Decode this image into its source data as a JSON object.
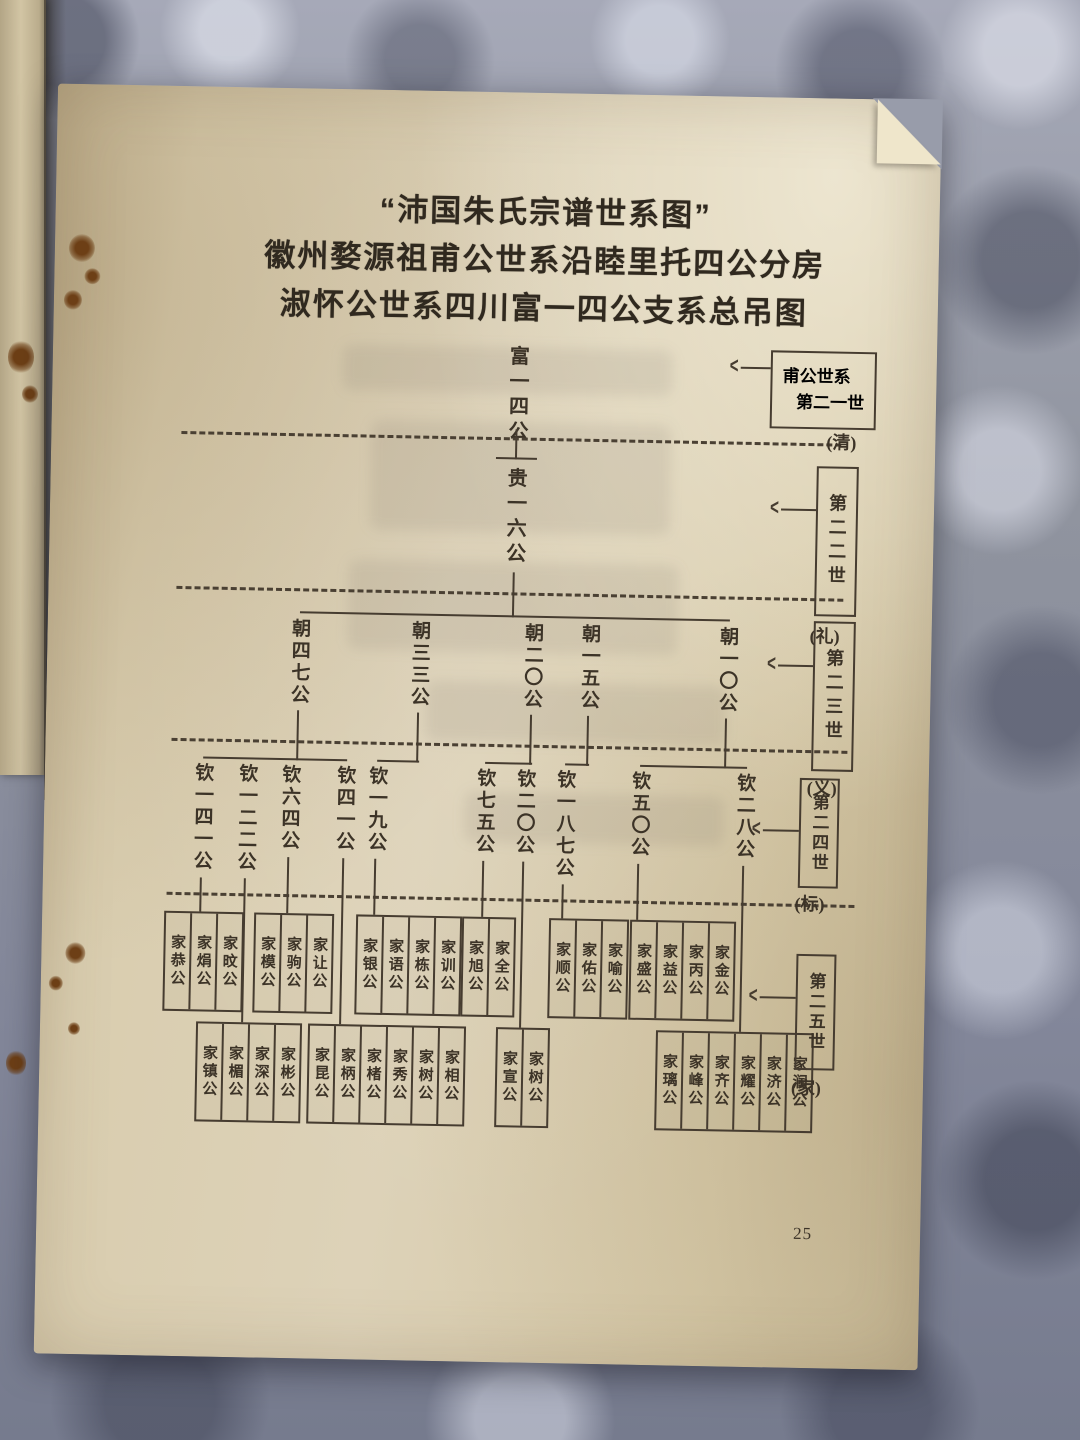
{
  "colors": {
    "ink": "#463c30",
    "paper": "#d9cdaf",
    "fabric": "#8f93a2"
  },
  "icons": {
    "generation_pointer": "<"
  },
  "page": {
    "page_number": "25"
  },
  "title": {
    "line1": "“沛国朱氏宗谱世系图”",
    "line2": "徽州婺源祖甫公世系沿睦里托四公分房",
    "line3": "淑怀公世系四川富一四公支系总吊图"
  },
  "generation_labels": [
    {
      "line1": "甫公世系",
      "line2": "第二一世",
      "note": "(清)"
    },
    {
      "label": "第二二世",
      "note": "(礼)"
    },
    {
      "label": "第二三世",
      "note": "(义)"
    },
    {
      "label": "第二四世",
      "note": "(标)"
    },
    {
      "label": "第二五世",
      "note": "(家)"
    }
  ],
  "tree": {
    "gen1": "富一四公",
    "gen2": "贵一六公",
    "gen3": [
      "朝四七公",
      "朝三三公",
      "朝二〇公",
      "朝一五公",
      "朝一〇公"
    ],
    "gen4": [
      "钦一四一公",
      "钦一二二公",
      "钦六四公",
      "钦四一公",
      "钦一九公",
      "钦七五公",
      "钦二〇公",
      "钦一八七公",
      "钦五〇公",
      "钦二八公"
    ],
    "gen5_groups": [
      {
        "tier": "upper",
        "parent": "钦一四一公",
        "members": [
          "家恭公",
          "家焆公",
          "家旼公"
        ]
      },
      {
        "tier": "lower",
        "parent": "钦一二二公",
        "members": [
          "家镇公",
          "家楣公",
          "家深公",
          "家彬公"
        ]
      },
      {
        "tier": "upper",
        "parent": "钦六四公",
        "members": [
          "家模公",
          "家驹公",
          "家让公"
        ]
      },
      {
        "tier": "lower",
        "parent": "钦四一公",
        "members": [
          "家昆公",
          "家柄公",
          "家楮公",
          "家秀公",
          "家树公",
          "家相公"
        ]
      },
      {
        "tier": "upper",
        "parent": "钦一九公",
        "members": [
          "家银公",
          "家语公",
          "家栋公",
          "家训公"
        ]
      },
      {
        "tier": "upper",
        "parent": "钦七五公",
        "members": [
          "家旭公",
          "家全公"
        ]
      },
      {
        "tier": "lower",
        "parent": "钦二〇公",
        "members": [
          "家宣公",
          "家树公"
        ]
      },
      {
        "tier": "upper",
        "parent": "钦一八七公",
        "members": [
          "家顺公",
          "家佑公",
          "家喻公"
        ]
      },
      {
        "tier": "upper",
        "parent": "钦五〇公",
        "members": [
          "家盛公",
          "家益公",
          "家丙公",
          "家金公"
        ]
      },
      {
        "tier": "lower",
        "parent": "钦二八公",
        "members": [
          "家璃公",
          "家峰公",
          "家齐公",
          "家耀公",
          "家济公",
          "家润公"
        ]
      }
    ]
  }
}
